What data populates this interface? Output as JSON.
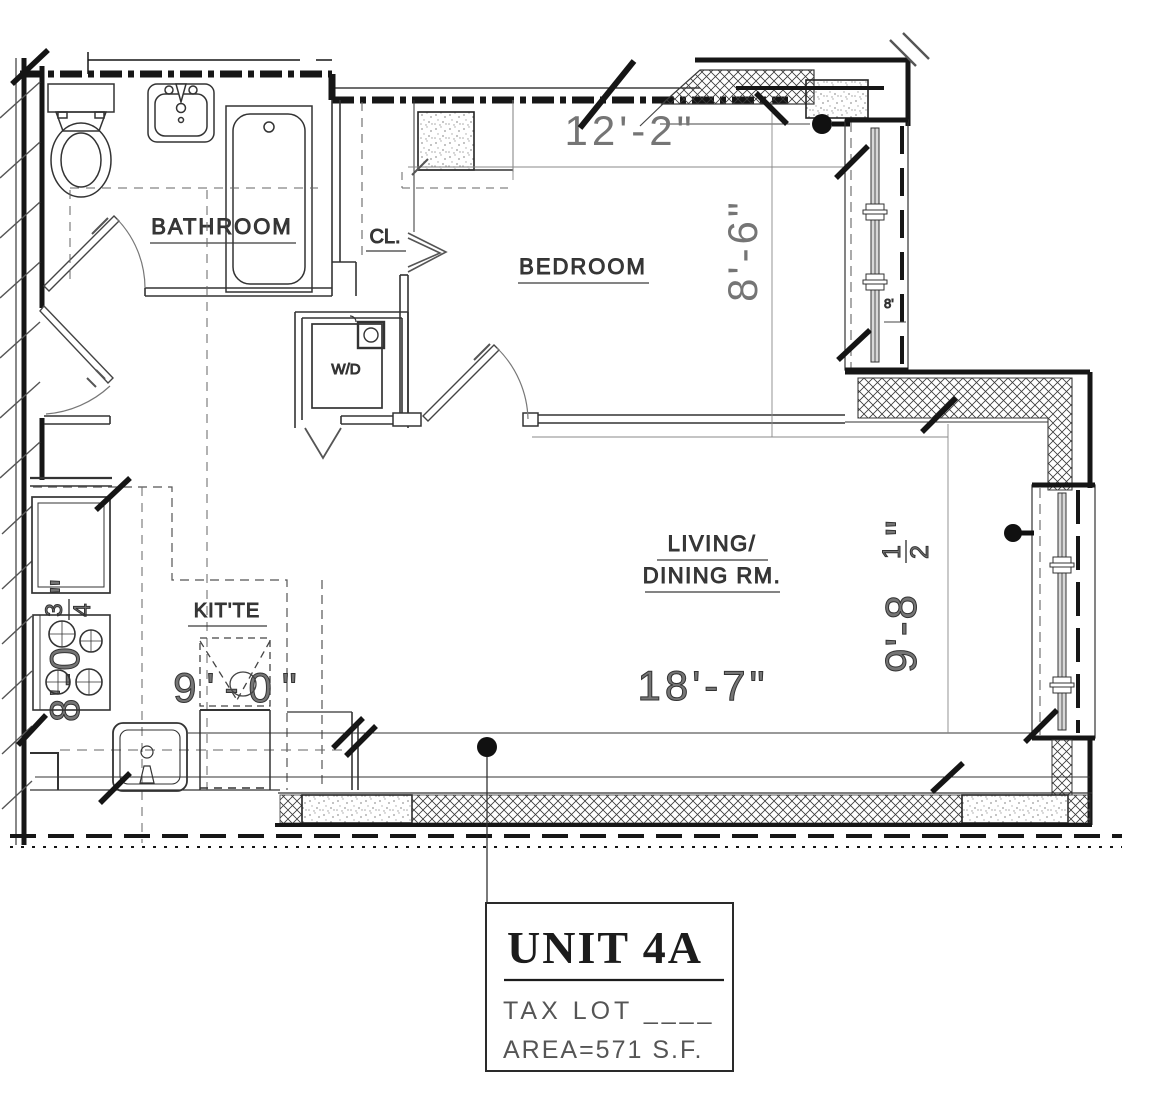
{
  "labels": {
    "bathroom": "BATHROOM",
    "closet": "CL.",
    "bedroom": "BEDROOM",
    "washer_dryer": "W/D",
    "kitchenette": "KIT'TE",
    "living_line1": "LIVING/",
    "living_line2": "DINING RM."
  },
  "dims": {
    "bedroom_width": "12'-2\"",
    "bedroom_depth": "8'-6\"",
    "living_width": "18'-7\"",
    "kitchen_width": "9'-0\"",
    "living_depth": {
      "feet": "9'-8",
      "num": "1",
      "den": "2",
      "inch": "\""
    },
    "kitchen_depth": {
      "feet": "8'-0",
      "num": "3",
      "den": "4",
      "inch": "\""
    },
    "window_tag": "8'"
  },
  "unit_box": {
    "title": "UNIT 4A",
    "tax_lot": "TAX LOT ____",
    "area": "AREA=571 S.F."
  },
  "colors": {
    "wall": "#161616",
    "dim_text": "#757575",
    "label_text": "#3a3a3a"
  }
}
